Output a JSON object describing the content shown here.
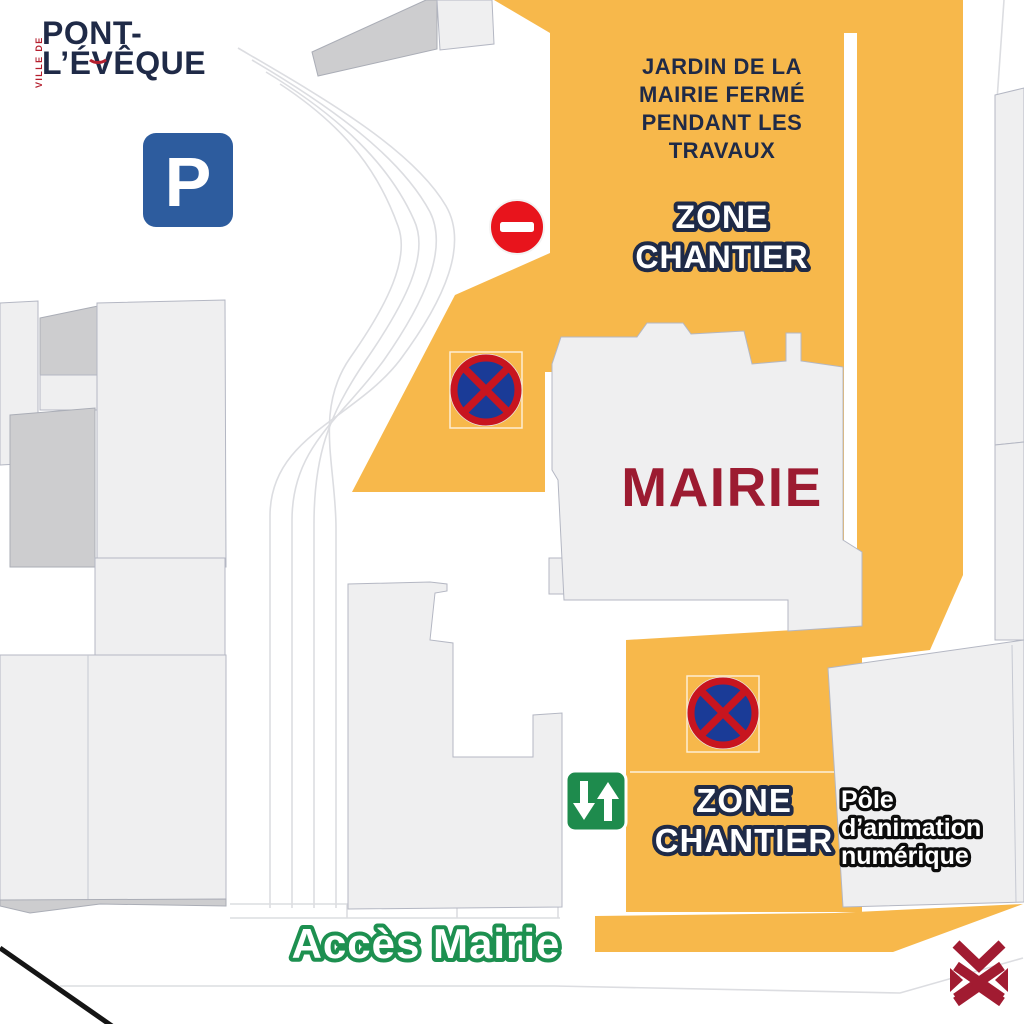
{
  "logo": {
    "prefix": "VILLE DE",
    "line1": "PONT-",
    "line2": "L’ÉVÊQUE"
  },
  "labels": {
    "garden_notice": {
      "lines": [
        "JARDIN DE LA",
        "MAIRIE FERMÉ",
        "PENDANT LES",
        "TRAVAUX"
      ]
    },
    "zone_chantier_top": {
      "lines": [
        "ZONE",
        "CHANTIER"
      ]
    },
    "zone_chantier_bottom": {
      "lines": [
        "ZONE",
        "CHANTIER"
      ]
    },
    "mairie": "MAIRIE",
    "pole_animation": {
      "lines": [
        "Pôle",
        "d’animation",
        "numérique"
      ]
    },
    "acces_mairie": "Accès Mairie"
  },
  "signs": {
    "parking": {
      "label": "P",
      "color": "#2D5C9E"
    },
    "no_entry": {
      "color": "#E8141C"
    },
    "no_stopping": {
      "ring_color": "#C8151F",
      "center_color": "#1A3B97"
    },
    "two_way_traffic": {
      "color": "#1E8B4D"
    }
  },
  "colors": {
    "zone_orange": "#F7B84B",
    "navy": "#1F2A47",
    "mairie_red": "#9C1B31",
    "green_text": "#1D9050",
    "building_fill": "#EFEFF0",
    "building_dark": "#CDCDCF",
    "emblem_red": "#A11B31"
  }
}
